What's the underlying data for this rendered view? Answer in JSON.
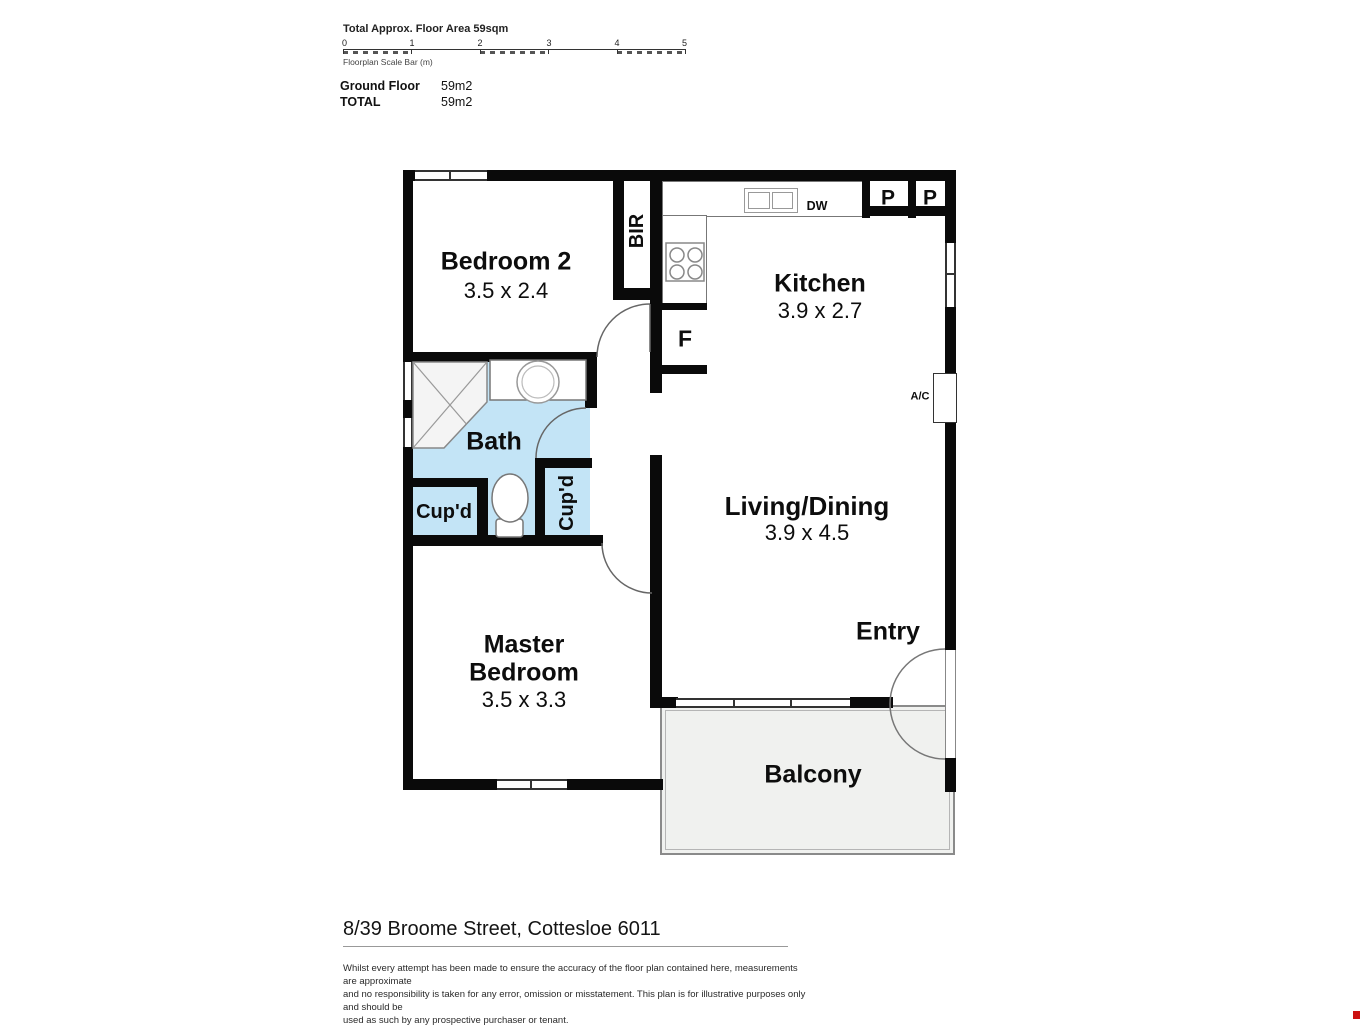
{
  "header": {
    "total_area_label": "Total Approx. Floor Area 59sqm",
    "scale_ticks": [
      "0",
      "1",
      "2",
      "3",
      "4",
      "5"
    ],
    "scale_caption": "Floorplan Scale Bar (m)",
    "area_rows": [
      {
        "label": "Ground Floor",
        "value": "59m2"
      },
      {
        "label": "TOTAL",
        "value": "59m2"
      }
    ]
  },
  "rooms": {
    "bedroom2": {
      "name": "Bedroom 2",
      "dims": "3.5 x 2.4"
    },
    "kitchen": {
      "name": "Kitchen",
      "dims": "3.9 x 2.7"
    },
    "living": {
      "name": "Living/Dining",
      "dims": "3.9 x 4.5"
    },
    "master": {
      "line1": "Master",
      "line2": "Bedroom",
      "dims": "3.5 x 3.3"
    },
    "bath": {
      "name": "Bath"
    },
    "entry": {
      "name": "Entry"
    },
    "balcony": {
      "name": "Balcony"
    }
  },
  "fixtures": {
    "bir": "BIR",
    "fridge": "F",
    "dishwasher": "DW",
    "pantry1": "P",
    "pantry2": "P",
    "ac": "A/C",
    "cupboard1": "Cup'd",
    "cupboard2": "Cup'd"
  },
  "colors": {
    "wall": "#0a0a0a",
    "bath_floor": "#c3e4f6",
    "balcony_floor": "#f0f1ef",
    "watermark": "#cc1111"
  },
  "footer": {
    "address": "8/39 Broome Street, Cottesloe 6011",
    "disclaimer_lines": [
      "Whilst every attempt has been made to ensure the accuracy of the floor plan contained here, measurements are approximate",
      "and no responsibility is taken for any error, omission or misstatement. This plan is for illustrative purposes only and should be",
      "used as such by any prospective purchaser or tenant."
    ]
  }
}
